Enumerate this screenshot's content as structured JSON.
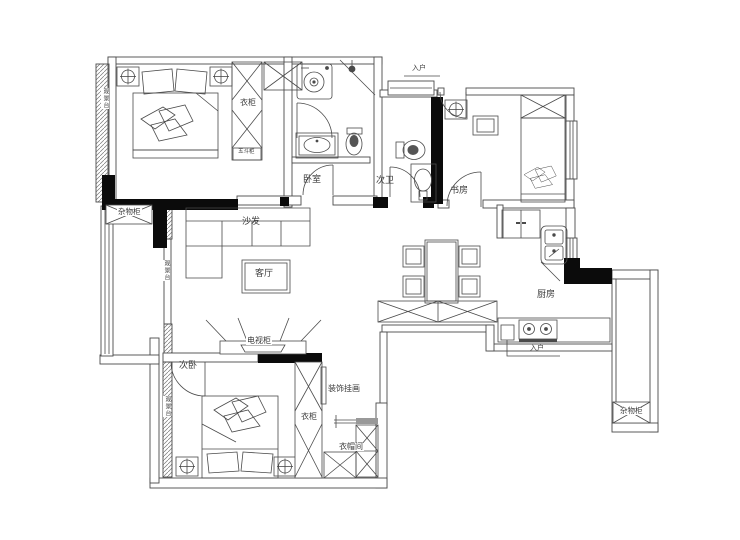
{
  "colors": {
    "line": "#4a4a4a",
    "solid_wall": "#0b0b0b",
    "background": "#ffffff"
  },
  "rooms": {
    "master_bedroom": "卧室",
    "guest_bathroom": "次卫",
    "study": "书房",
    "living_room": "客厅",
    "second_bedroom": "次卧",
    "kitchen": "厨房",
    "cloakroom": "衣帽间"
  },
  "furniture": {
    "sofa": "沙发",
    "tv_cabinet": "电视柜",
    "master_wardrobe": "衣柜",
    "second_wardrobe": "衣柜",
    "chest_of_drawers": "五斗柜",
    "storage_cabinet_left": "杂物柜",
    "storage_cabinet_right": "杂物柜",
    "decorative_painting": "装饰挂画"
  },
  "annotations": {
    "entry_top": "入户",
    "entry_bottom": "入户",
    "balcony_left_top": "观景台",
    "balcony_left_mid": "观景台",
    "balcony_left_bottom": "观景台"
  }
}
